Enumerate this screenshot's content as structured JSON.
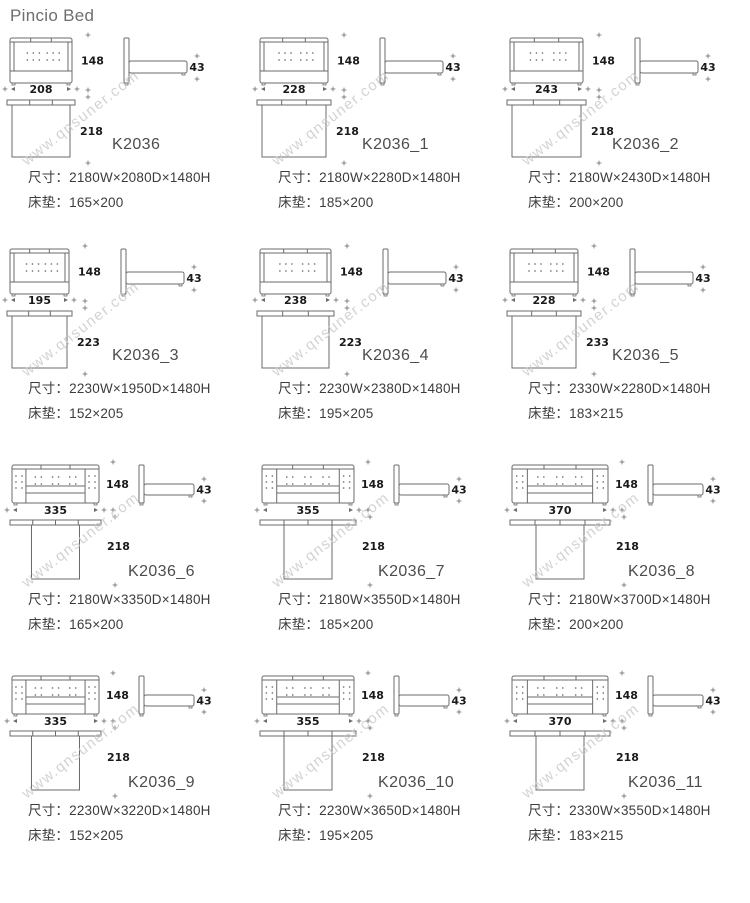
{
  "page_title": "Pincio Bed",
  "watermark": "www.qnsuner.com",
  "labels": {
    "size": "尺寸：",
    "mattress": "床垫："
  },
  "colors": {
    "line": "#6b6b6b",
    "dim_text": "#1a1a1a",
    "model_text": "#4d4d4d",
    "spec_text": "#3c3c3c",
    "title_text": "#6e6e6e",
    "watermark": "#c9c9c9"
  },
  "cells": [
    {
      "model": "K2036",
      "style": "A",
      "w": 208,
      "h": 148,
      "d": 218,
      "t": 43,
      "size": "2180W×2080D×1480H",
      "mattress": "165×200"
    },
    {
      "model": "K2036_1",
      "style": "A",
      "w": 228,
      "h": 148,
      "d": 218,
      "t": 43,
      "size": "2180W×2280D×1480H",
      "mattress": "185×200"
    },
    {
      "model": "K2036_2",
      "style": "A",
      "w": 243,
      "h": 148,
      "d": 218,
      "t": 43,
      "size": "2180W×2430D×1480H",
      "mattress": "200×200"
    },
    {
      "model": "K2036_3",
      "style": "A",
      "w": 195,
      "h": 148,
      "d": 223,
      "t": 43,
      "size": "2230W×1950D×1480H",
      "mattress": "152×205"
    },
    {
      "model": "K2036_4",
      "style": "A",
      "w": 238,
      "h": 148,
      "d": 223,
      "t": 43,
      "size": "2230W×2380D×1480H",
      "mattress": "195×205"
    },
    {
      "model": "K2036_5",
      "style": "A",
      "w": 228,
      "h": 148,
      "d": 233,
      "t": 43,
      "size": "2330W×2280D×1480H",
      "mattress": "183×215"
    },
    {
      "model": "K2036_6",
      "style": "B",
      "w": 335,
      "h": 148,
      "d": 218,
      "t": 43,
      "size": "2180W×3350D×1480H",
      "mattress": "165×200"
    },
    {
      "model": "K2036_7",
      "style": "B",
      "w": 355,
      "h": 148,
      "d": 218,
      "t": 43,
      "size": "2180W×3550D×1480H",
      "mattress": "185×200"
    },
    {
      "model": "K2036_8",
      "style": "B",
      "w": 370,
      "h": 148,
      "d": 218,
      "t": 43,
      "size": "2180W×3700D×1480H",
      "mattress": "200×200"
    },
    {
      "model": "K2036_9",
      "style": "B",
      "w": 335,
      "h": 148,
      "d": 218,
      "t": 43,
      "size": "2230W×3220D×1480H",
      "mattress": "152×205"
    },
    {
      "model": "K2036_10",
      "style": "B",
      "w": 355,
      "h": 148,
      "d": 218,
      "t": 43,
      "size": "2230W×3650D×1480H",
      "mattress": "195×205"
    },
    {
      "model": "K2036_11",
      "style": "B",
      "w": 370,
      "h": 148,
      "d": 218,
      "t": 43,
      "size": "2330W×3550D×1480H",
      "mattress": "183×215"
    }
  ]
}
